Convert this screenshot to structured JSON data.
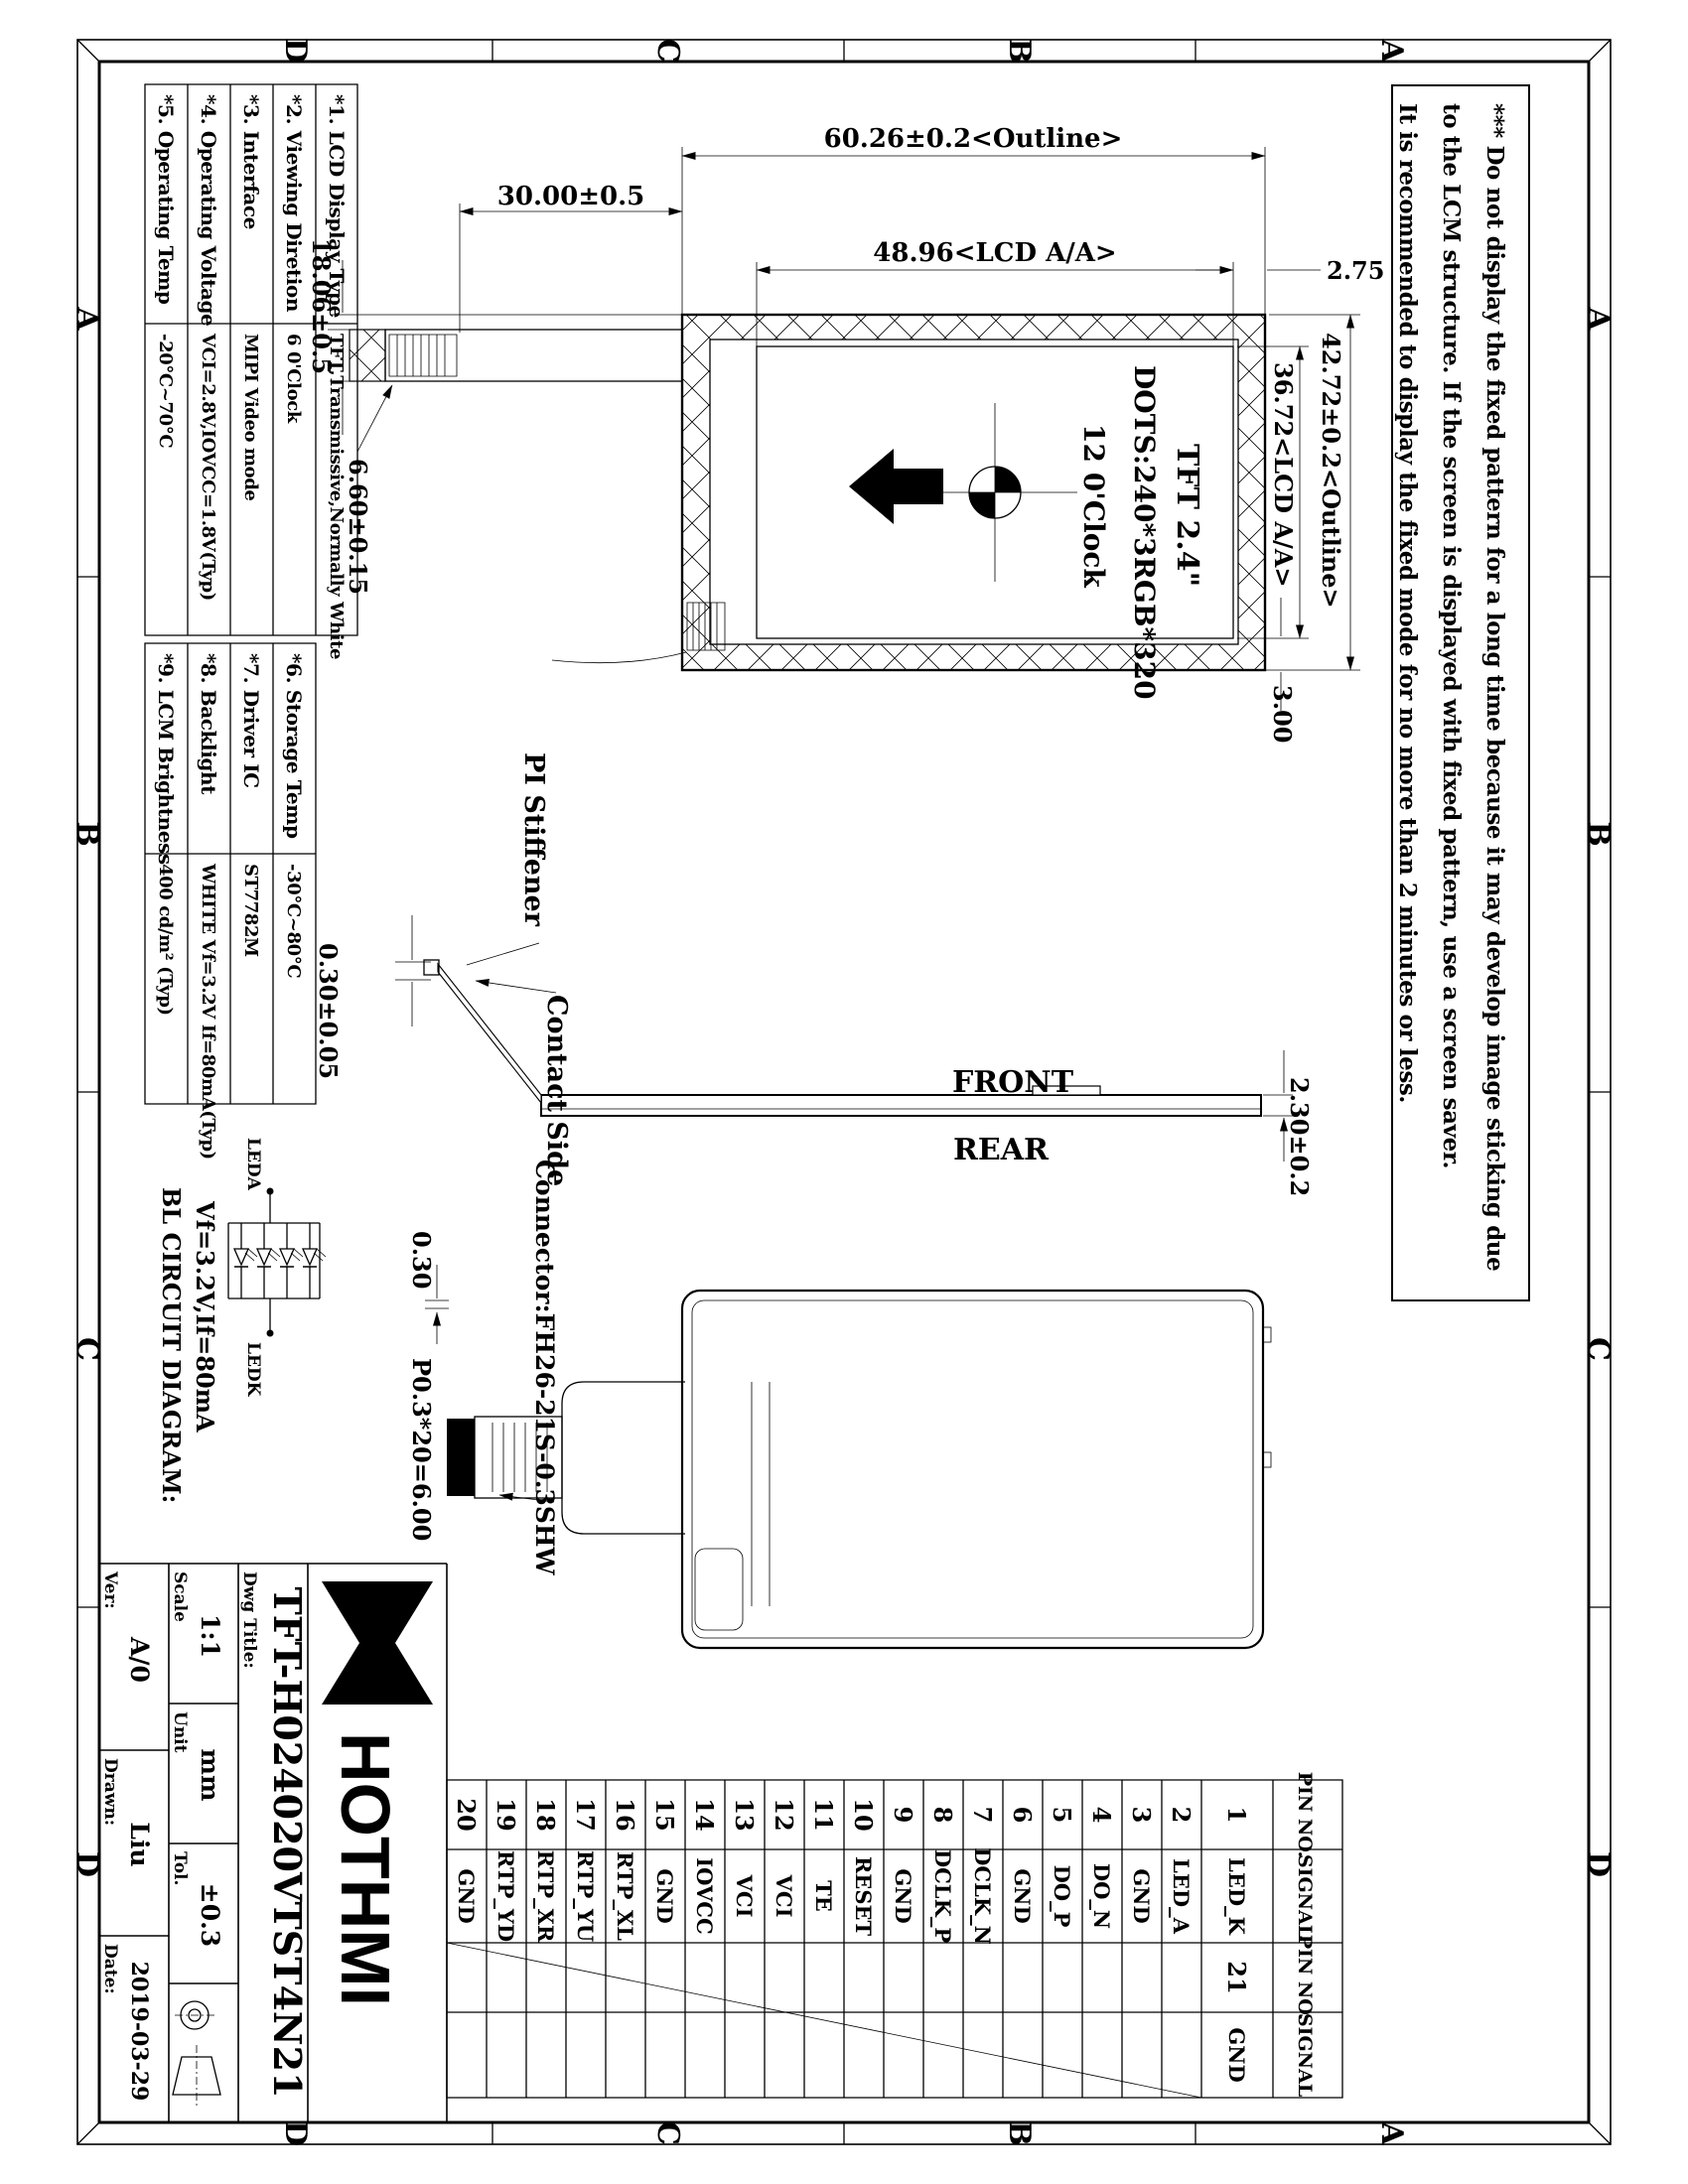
{
  "border": {
    "zones_top": [
      "D",
      "C",
      "B",
      "A"
    ],
    "zones_bottom": [
      "D",
      "C",
      "B",
      "A"
    ],
    "zones_left": [
      "A",
      "B",
      "C",
      "D"
    ],
    "zones_right": [
      "A",
      "B",
      "C",
      "D"
    ]
  },
  "notes": {
    "lines": [
      "*** Do not display the fixed pattern for a long time because it may develop image sticking due",
      "to the LCM structure. If the screen is displayed with fixed pattern, use a screen saver.",
      "It is recommended to display the fixed mode for no more than 2 minutes or less."
    ]
  },
  "spec": {
    "items": [
      {
        "label": "*1. LCD Display Type",
        "value": "TFT,Transmissive,Normally White"
      },
      {
        "label": "*2. Viewing Diretion",
        "value": "6 0'Clock"
      },
      {
        "label": "*3. Interface",
        "value": "MIPI Video mode"
      },
      {
        "label": "*4. Operating Voltage",
        "value": "VCI=2.8V,IOVCC=1.8V(Typ)"
      },
      {
        "label": "*5. Operating Temp",
        "value": "-20°C~70°C"
      },
      {
        "label": "*6. Storage Temp",
        "value": "-30°C~80°C"
      },
      {
        "label": "*7. Driver IC",
        "value": "ST7782M"
      },
      {
        "label": "*8. Backlight",
        "value": "WHITE Vf=3.2V If=80mA(Typ)"
      },
      {
        "label": "*9. LCM Brightness",
        "value": "400 cd/m² (Typ)"
      }
    ]
  },
  "front": {
    "title": "TFT 2.4\"",
    "dots": "DOTS:240*3RGB*320",
    "clock": "12 0'Clock",
    "dim_fpc": "30.00±0.5",
    "dim_outline_w": "60.26±0.2<Outline>",
    "dim_aa_w": "48.96<LCD A/A>",
    "dim_aa_offset": "2.75",
    "dim_fpc_pos": "18.06±0.5",
    "dim_fpc_w": "6.60±0.15",
    "dim_outline_h": "42.72±0.2<Outline>",
    "dim_aa_h": "36.72<LCD A/A>",
    "dim_bottom_margin": "3.00"
  },
  "side": {
    "front_label": "FRONT",
    "rear_label": "REAR",
    "stiffener_label": "PI Stiffener",
    "contact_label": "Contact Side",
    "dim_stiffener_t": "0.30±0.05",
    "dim_thickness": "2.30±0.2"
  },
  "rear": {
    "connector": "Connector:FH26-21S-0.3SHW",
    "dim_pin_w": "0.30",
    "dim_pitch": "P0.3*20=6.00"
  },
  "pins": {
    "headers": [
      "PIN NO.",
      "SIGNAL",
      "PIN NO.",
      "SIGNAL"
    ],
    "list": [
      {
        "no": "1",
        "signal": "LED_K"
      },
      {
        "no": "2",
        "signal": "LED_A"
      },
      {
        "no": "3",
        "signal": "GND"
      },
      {
        "no": "4",
        "signal": "DO_N"
      },
      {
        "no": "5",
        "signal": "DO_P"
      },
      {
        "no": "6",
        "signal": "GND"
      },
      {
        "no": "7",
        "signal": "DCLK_N"
      },
      {
        "no": "8",
        "signal": "DCLK_P"
      },
      {
        "no": "9",
        "signal": "GND"
      },
      {
        "no": "10",
        "signal": "RESET"
      },
      {
        "no": "11",
        "signal": "TE"
      },
      {
        "no": "12",
        "signal": "VCI"
      },
      {
        "no": "13",
        "signal": "VCI"
      },
      {
        "no": "14",
        "signal": "IOVCC"
      },
      {
        "no": "15",
        "signal": "GND"
      },
      {
        "no": "16",
        "signal": "RTP_XL"
      },
      {
        "no": "17",
        "signal": "RTP_YU"
      },
      {
        "no": "18",
        "signal": "RTP_XR"
      },
      {
        "no": "19",
        "signal": "RTP_YD"
      },
      {
        "no": "20",
        "signal": "GND"
      }
    ],
    "extra": {
      "no": "21",
      "signal": "GND"
    }
  },
  "bl": {
    "title": "BL CIRCUIT DIAGRAM:",
    "spec": "Vf=3.2V,If=80mA",
    "anode": "LEDA",
    "cathode": "LEDK"
  },
  "tb": {
    "dwg_title_label": "Dwg Title:",
    "part_number": "TFT-H024020VTST4N21",
    "scale_label": "Scale",
    "scale": "1:1",
    "unit_label": "Unit",
    "unit": "mm",
    "tol_label": "Tol.",
    "tol": "±0.3",
    "ver_label": "Ver:",
    "ver": "A/0",
    "drawn_label": "Drawn:",
    "drawn": "Liu",
    "date_label": "Date:",
    "date": "2019-03-29",
    "brand": "HOTHMI",
    "logo_letter": "H"
  }
}
